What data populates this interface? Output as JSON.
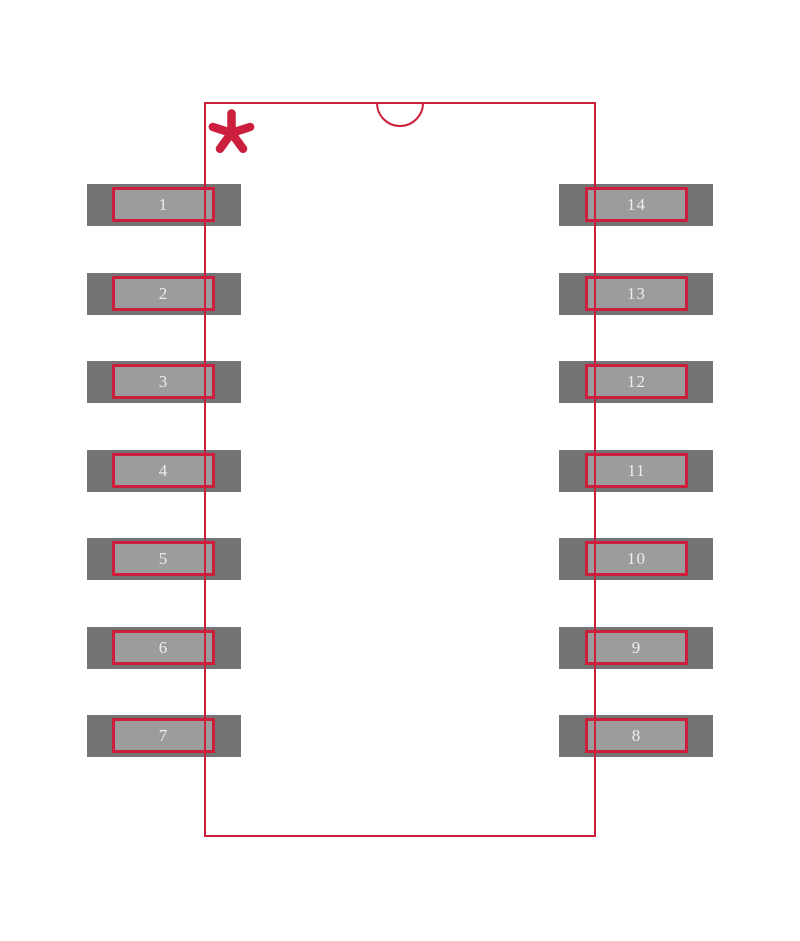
{
  "diagram": {
    "kind": "ic-land-pattern-footprint",
    "background_color": "#ffffff",
    "colors": {
      "outline_red": "#cb1f3d",
      "pad_fill_gray": "#747474",
      "pin_overlay_fill_gray": "#9c9c9c",
      "pin_number_text": "#eeeeee"
    },
    "pin_count": 14,
    "pin1_marker": "asterisk",
    "body_notch": "top-center-semicircle",
    "pads": {
      "left_top_to_bottom": [
        "1",
        "2",
        "3",
        "4",
        "5",
        "6",
        "7"
      ],
      "right_top_to_bottom": [
        "14",
        "13",
        "12",
        "11",
        "10",
        "9",
        "8"
      ]
    }
  }
}
